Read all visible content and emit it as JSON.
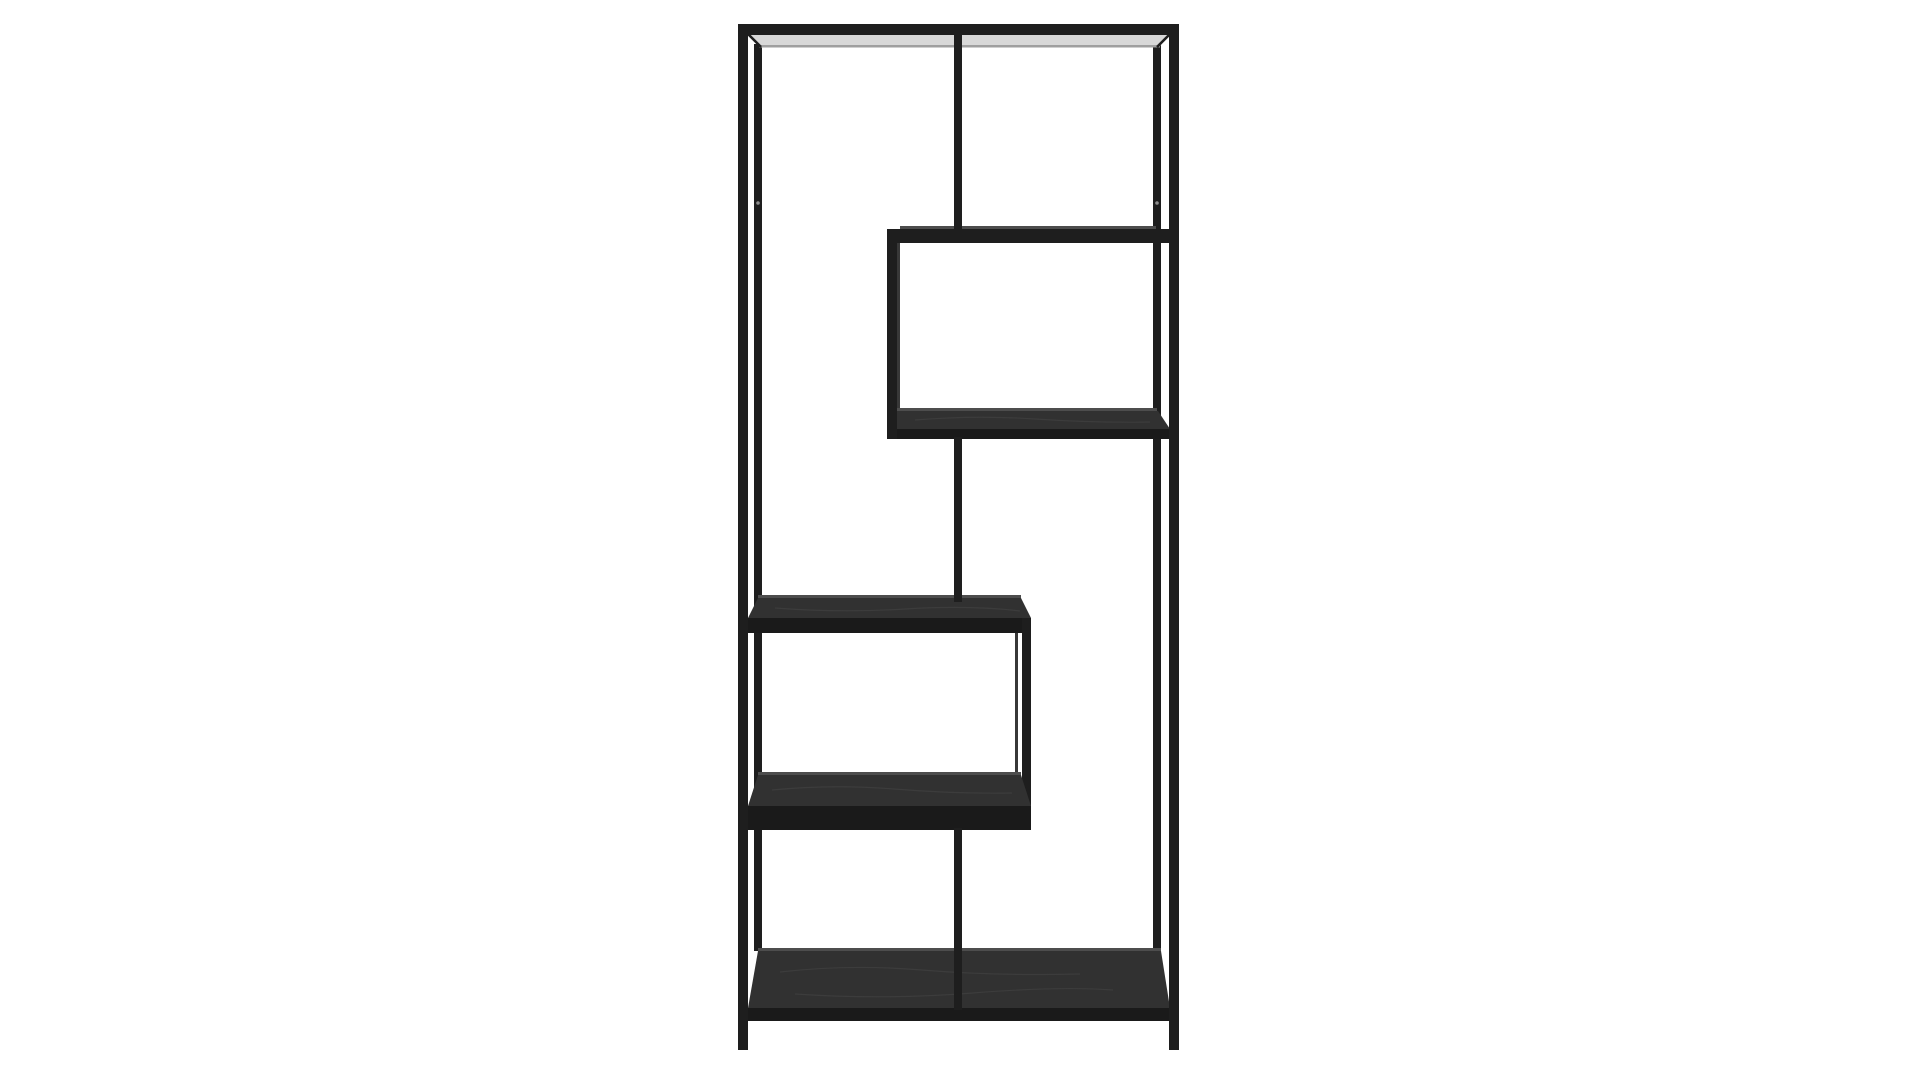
{
  "page": {
    "background": "#ffffff"
  },
  "product_photo": {
    "subject": "Asymmetric tall black metal bookshelf with staggered box shelves on a plain white studio background",
    "colors": {
      "background": "#ffffff",
      "metal": "#1e1e1e",
      "metal_faint": "#383838",
      "wood": "#313131",
      "wood_edge": "#1a1a1a",
      "underside": "#d8d8d8",
      "panel_edge": "#9f9f9f",
      "sliver": "#4d4d4d",
      "grain": "#464646",
      "dot": "#8d8d8d"
    }
  }
}
